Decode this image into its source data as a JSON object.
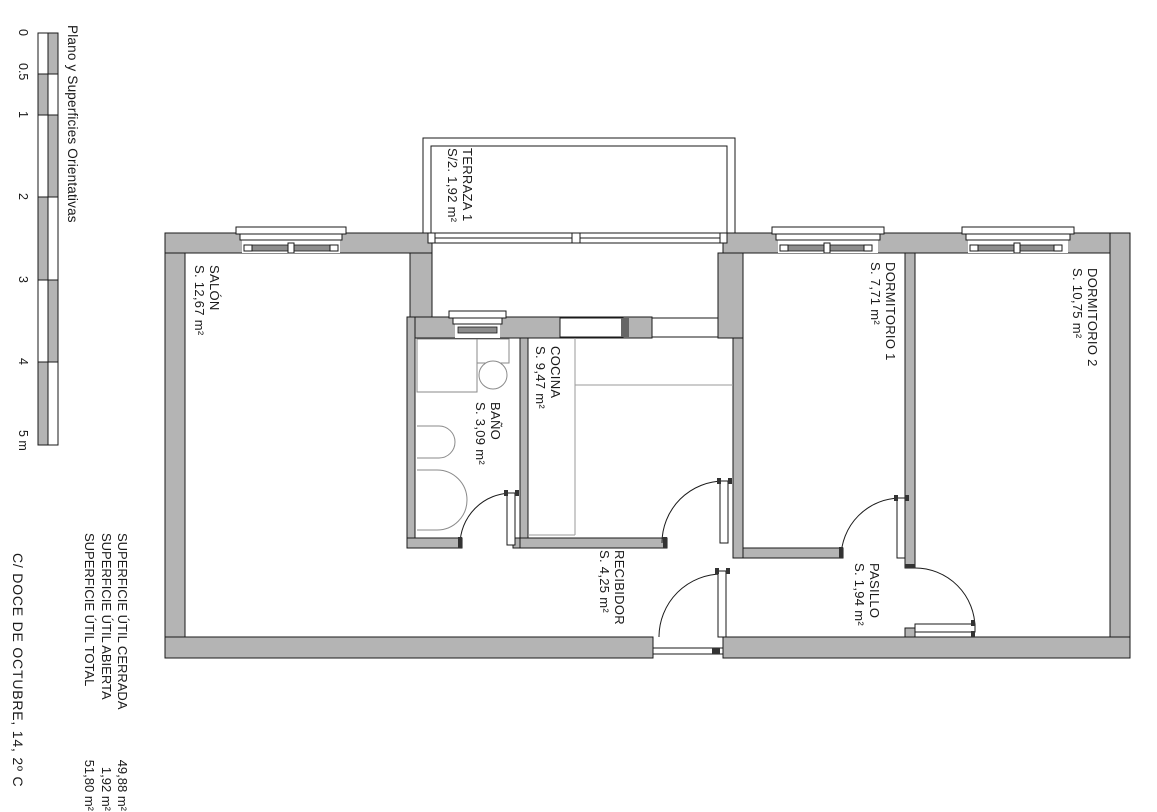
{
  "title": "Plano y Superficies Orientativas",
  "address": "C/ DOCE DE OCTUBRE, 14, 2º C",
  "scale_bar": {
    "unit": "m",
    "labels": [
      "0",
      "0.5",
      "1",
      "2",
      "3",
      "4",
      "5 m"
    ]
  },
  "rooms": [
    {
      "id": "terraza1",
      "name": "TERRAZA 1",
      "area": "S/2. 1,92 m²"
    },
    {
      "id": "salon",
      "name": "SALÓN",
      "area": "S. 12,67 m²"
    },
    {
      "id": "cocina",
      "name": "COCINA",
      "area": "S. 9,47 m²"
    },
    {
      "id": "bano",
      "name": "BAÑO",
      "area": "S. 3,09 m²"
    },
    {
      "id": "recibidor",
      "name": "RECIBIDOR",
      "area": "S. 4,25 m²"
    },
    {
      "id": "pasillo",
      "name": "PASILLO",
      "area": "S. 1,94 m²"
    },
    {
      "id": "dormitorio1",
      "name": "DORMITORIO 1",
      "area": "S. 7,71 m²"
    },
    {
      "id": "dormitorio2",
      "name": "DORMITORIO 2",
      "area": "S. 10,75 m²"
    }
  ],
  "summary": {
    "rows": [
      {
        "label": "SUPERFICIE ÚTIL CERRADA",
        "value": "49,88 m²"
      },
      {
        "label": "SUPERFICIE ÚTIL ABIERTA",
        "value": "1,92 m²"
      },
      {
        "label": "SUPERFICIE ÚTIL TOTAL",
        "value": "51,80 m²"
      }
    ]
  },
  "colors": {
    "wall_fill": "#b4b4b4",
    "line": "#1a1a1a",
    "glass": "#8c8c8c",
    "background": "#ffffff"
  }
}
